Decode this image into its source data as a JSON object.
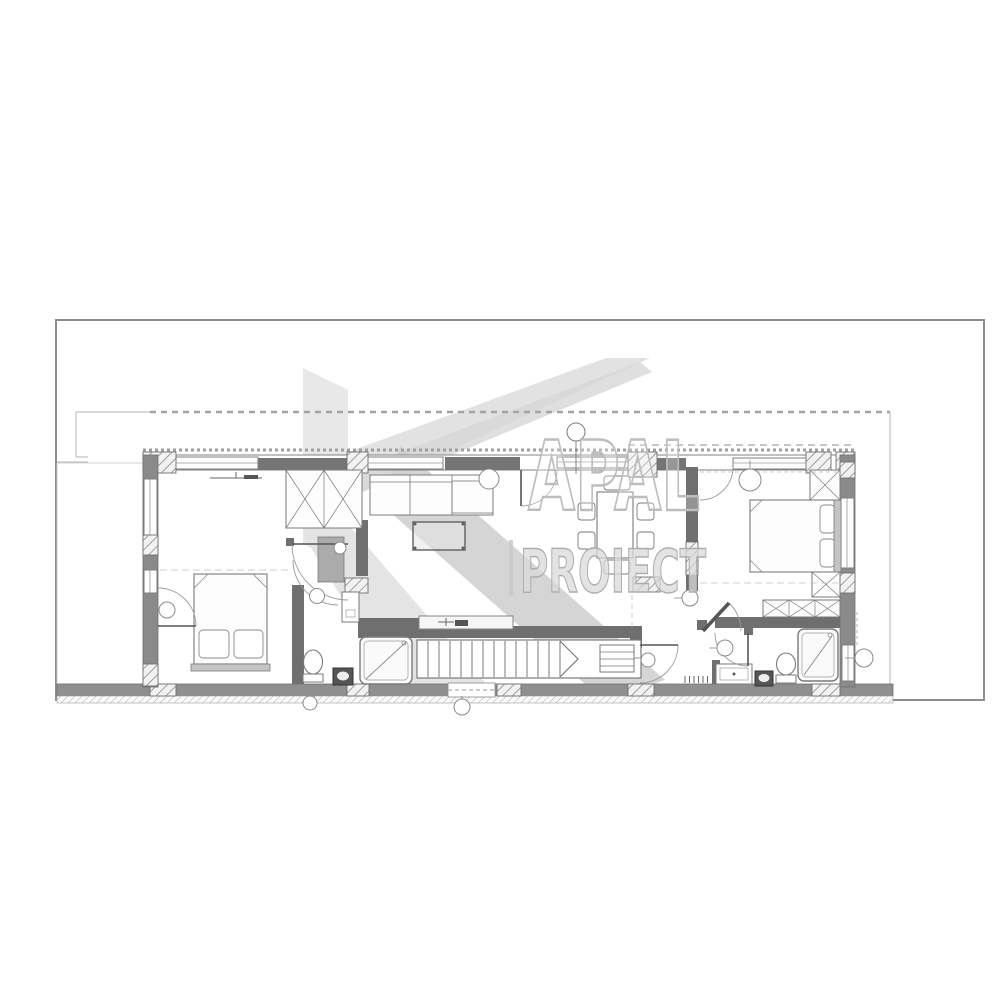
{
  "watermark": {
    "brand_top": "APAL",
    "brand_bottom": "PROIECT",
    "divider": "|",
    "color_light": "#e4e4e4",
    "color_mid": "#c9c9c9",
    "letter_outline": "#bdbdbd"
  },
  "palette": {
    "page_background": "#ffffff",
    "sheet_border": "#8d8d8d",
    "wall_dark": "#757575",
    "wall_band": "#8f8f8f",
    "plan_line": "#7a7a7a",
    "light_line": "#b9b9b9",
    "furniture_fill": "#fdfdfd",
    "headboard_fill": "#c4c4c4"
  },
  "plan": {
    "drawing_type": "architectural-floor-plan-upper-storey",
    "elements": [
      "exterior-walls",
      "insulation-hatch-piers",
      "windows",
      "interior-walls",
      "swing-doors",
      "staircase-with-direction-arrow",
      "double-bed-left",
      "double-bed-right",
      "wardrobe-x-boxes",
      "corner-sofa",
      "coffee-table",
      "dining-table-six-chairs",
      "kitchen-counter-with-faucet",
      "shower-cabins",
      "toilets",
      "floor-drains",
      "vanity-cabinets",
      "ceiling-light-symbols",
      "radiator-ticks",
      "roof-overhang-dashed-line",
      "terrace-strip-hatch"
    ]
  }
}
